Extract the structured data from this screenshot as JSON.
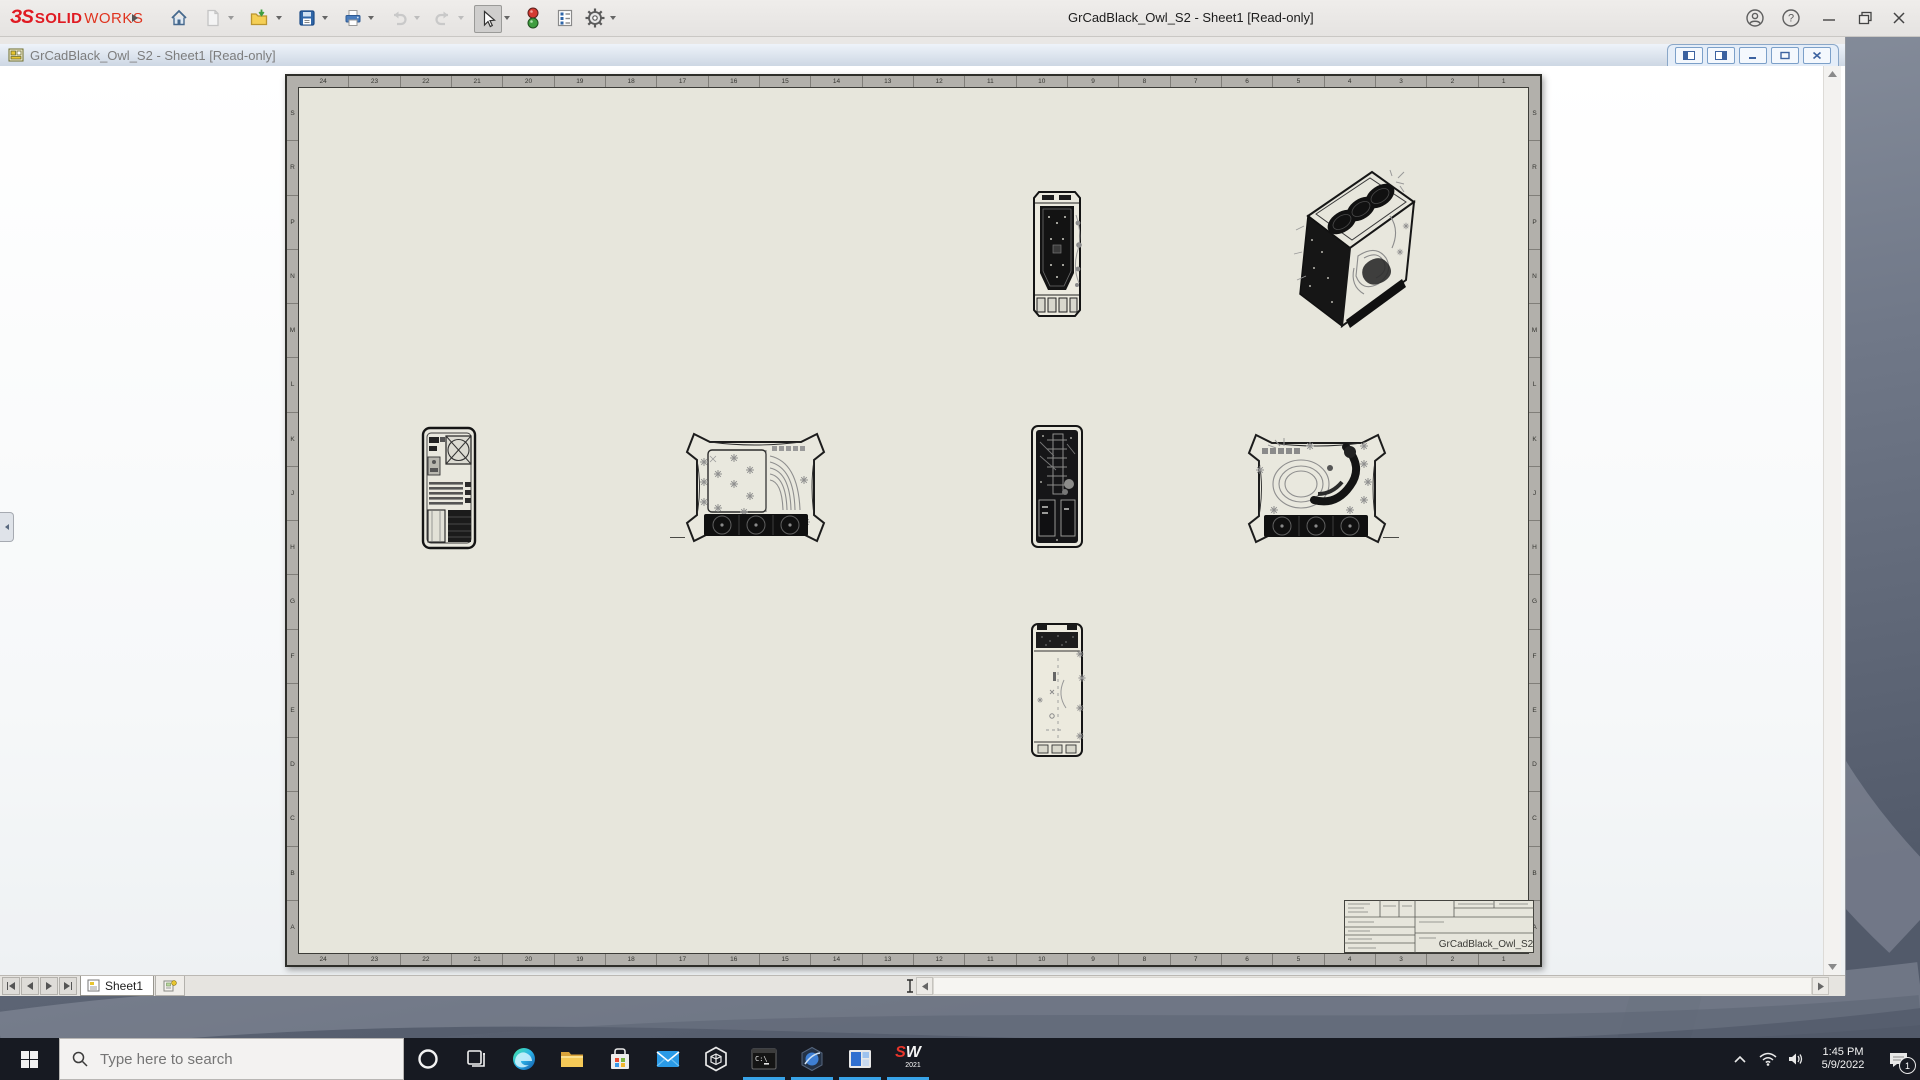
{
  "titlebar": {
    "brand_glyph": "ЗS",
    "brand_bold": "SOLID",
    "brand_rest": "WORKS",
    "window_title": "GrCadBlack_Owl_S2 - Sheet1 [Read-only]",
    "help_glyph": "?",
    "tool_icons": [
      "home-icon",
      "new-file-icon",
      "open-icon",
      "save-icon",
      "print-icon",
      "undo-icon",
      "redo-icon",
      "select-cursor-icon",
      "display-states-icon",
      "properties-icon",
      "options-gear-icon"
    ],
    "accent_red": "#e01a22"
  },
  "docbar": {
    "doc_title": "GrCadBlack_Owl_S2 - Sheet1 [Read-only]"
  },
  "sheet": {
    "zones_top": [
      "24",
      "23",
      "22",
      "21",
      "20",
      "19",
      "18",
      "17",
      "16",
      "15",
      "14",
      "13",
      "12",
      "11",
      "10",
      "9",
      "8",
      "7",
      "6",
      "5",
      "4",
      "3",
      "2",
      "1"
    ],
    "zones_bottom": [
      "24",
      "23",
      "22",
      "21",
      "20",
      "19",
      "18",
      "17",
      "16",
      "15",
      "14",
      "13",
      "12",
      "11",
      "10",
      "9",
      "8",
      "7",
      "6",
      "5",
      "4",
      "3",
      "2",
      "1"
    ],
    "zones_left": [
      "S",
      "R",
      "P",
      "N",
      "M",
      "L",
      "K",
      "J",
      "H",
      "G",
      "F",
      "E",
      "D",
      "C",
      "B",
      "A"
    ],
    "zones_right": [
      "S",
      "R",
      "P",
      "N",
      "M",
      "L",
      "K",
      "J",
      "H",
      "G",
      "F",
      "E",
      "D",
      "C",
      "B",
      "A"
    ],
    "title_block_name": "GrCadBlack_Owl_S2",
    "paper_color": "#e7e6dc",
    "zone_strip_color": "#b2b0ab",
    "view_icons": [
      "front-view-top",
      "isometric-view",
      "rear-view",
      "side-view-left",
      "front-section-view",
      "side-view-right",
      "top-view"
    ]
  },
  "bottom_bar": {
    "sheet_tab_label": "Sheet1"
  },
  "taskbar": {
    "search_placeholder": "Type here to search",
    "terminal_glyph": "C:\\",
    "sw_logo": {
      "s": "S",
      "w": "W",
      "year": "2021"
    },
    "app_icons": [
      "edge-icon",
      "file-explorer-icon",
      "store-icon",
      "mail-icon",
      "3d-viewer-icon",
      "terminal-icon",
      "3dexperience-icon",
      "remote-app-icon",
      "solidworks-2021-icon"
    ],
    "running_apps": [
      "terminal",
      "3dexperience",
      "remote-app",
      "solidworks-2021"
    ],
    "tray": {
      "time": "1:45 PM",
      "date": "5/9/2022",
      "notification_count": "1"
    },
    "active_underline_color": "#38a3e8",
    "bar_color": "#171a22"
  }
}
